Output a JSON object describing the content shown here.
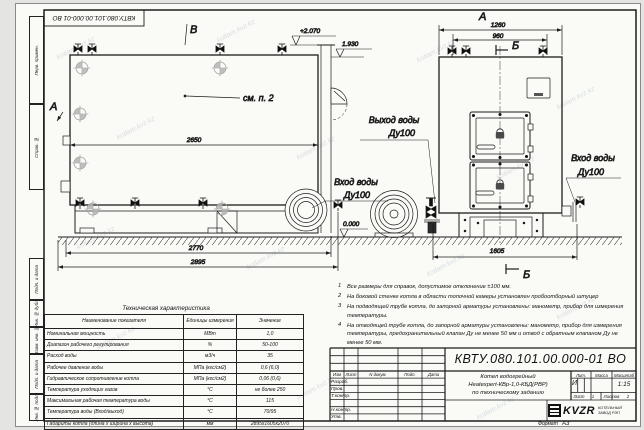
{
  "sheet": {
    "stamp_doc_number": "КВТУ.080.101.00.000-01 ВО",
    "watermark": "kotlam.kvz.kz",
    "format_label": "Формат",
    "format_value": "А3"
  },
  "margin_fields": {
    "perv_primen": "Перв. примен.",
    "sprav_no": "Справ. №",
    "podp_data_1": "Подп. и дата",
    "inv_dubl": "Инв. № дубл.",
    "vzam_inv": "Взам. инв. №",
    "podp_data_2": "Подп. и дата",
    "inv_podl": "Инв. № подл."
  },
  "views": {
    "side": {
      "view_letter_top": "В",
      "view_letter_left": "А",
      "note_ref": "см. п. 2",
      "dim_width": "2650",
      "dim_base": "2770",
      "dim_total": "2895",
      "elev_top": "+2.070",
      "elev_flue": "1.930",
      "elev_zero": "0.000",
      "outlet_line1": "Выход воды",
      "outlet_line2": "Ду100",
      "inlet_line1": "Вход воды",
      "inlet_line2": "Ду100"
    },
    "front": {
      "view_letter": "А",
      "section_letter_top": "Б",
      "section_letter_bottom": "Б",
      "dim_outer": "1260",
      "dim_inner": "960",
      "dim_base": "1605",
      "inlet_line1": "Вход воды",
      "inlet_line2": "Ду100"
    }
  },
  "tech_table": {
    "title": "Техническая характеристика",
    "headers": [
      "Наименование показателя",
      "Единицы измерения",
      "Значение"
    ],
    "rows": [
      [
        "Номинальная мощность",
        "МВт",
        "1,0"
      ],
      [
        "Диапазон рабочего регулирования",
        "%",
        "50-100"
      ],
      [
        "Расход воды",
        "м3/ч",
        "35"
      ],
      [
        "Рабочее давление воды",
        "МПа (кгс/см2)",
        "0,6 (6,0)"
      ],
      [
        "Гидравлическое сопротивление котла",
        "МПа (кгс/см2)",
        "0,06 (0,6)"
      ],
      [
        "Температура уходящих газов",
        "°С",
        "не более 250"
      ],
      [
        "Максимальная рабочая температура воды",
        "°С",
        "115"
      ],
      [
        "Температура воды (Вход/выход)",
        "°С",
        "70/95"
      ],
      [
        "Габариты котла (длина х ширина х высота)",
        "мм",
        "2895х1605х2070"
      ]
    ]
  },
  "notes": [
    {
      "num": "1",
      "text": "Все размеры для справок, допустимое отклонение ±100 мм."
    },
    {
      "num": "2",
      "text": "На боковой стенке котла в области топочной камеры установлен пробоотборный штуцер"
    },
    {
      "num": "3",
      "text": "На подводящей трубе котла, до запорной арматуры установлены: манометр, прибор для измерения температуры."
    },
    {
      "num": "4",
      "text": "На отводящей трубе котла, до запорной арматуры установлены: манометр, прибор для измерения температуры, предохранительный клапан Ду не менее 50 мм и отвод с обратным клапаном Ду не менее 50 мм."
    }
  ],
  "title_block": {
    "doc_number": "КВТУ.080.101.00.000-01 ВО",
    "name_line1": "Котел водогрейный",
    "name_line2": "Heatexpert-КВр-1,0-КБД(РВР)",
    "name_line3": "по техническому заданию",
    "col_izm": "Изм",
    "col_list": "Лист",
    "col_ndok": "N докум.",
    "col_podp": "Подп.",
    "col_data": "Дата",
    "row_razrab": "Разраб.",
    "row_prov": "Пров.",
    "row_tkontr": "Т.контр.",
    "row_nkontr": "Н.контр.",
    "row_utv": "Утв.",
    "lit_label": "Лит.",
    "lit_value": "И",
    "mass_label": "Масса",
    "scale_label": "Масштаб",
    "scale_value": "1:15",
    "sheet_label": "Лист",
    "sheet_value": "1",
    "sheets_label": "Листов",
    "sheets_value": "2",
    "company_logo": "KVZR",
    "company_line1": "КОТЕЛЬНЫЙ",
    "company_line2": "ЗАВОД РЭП"
  }
}
